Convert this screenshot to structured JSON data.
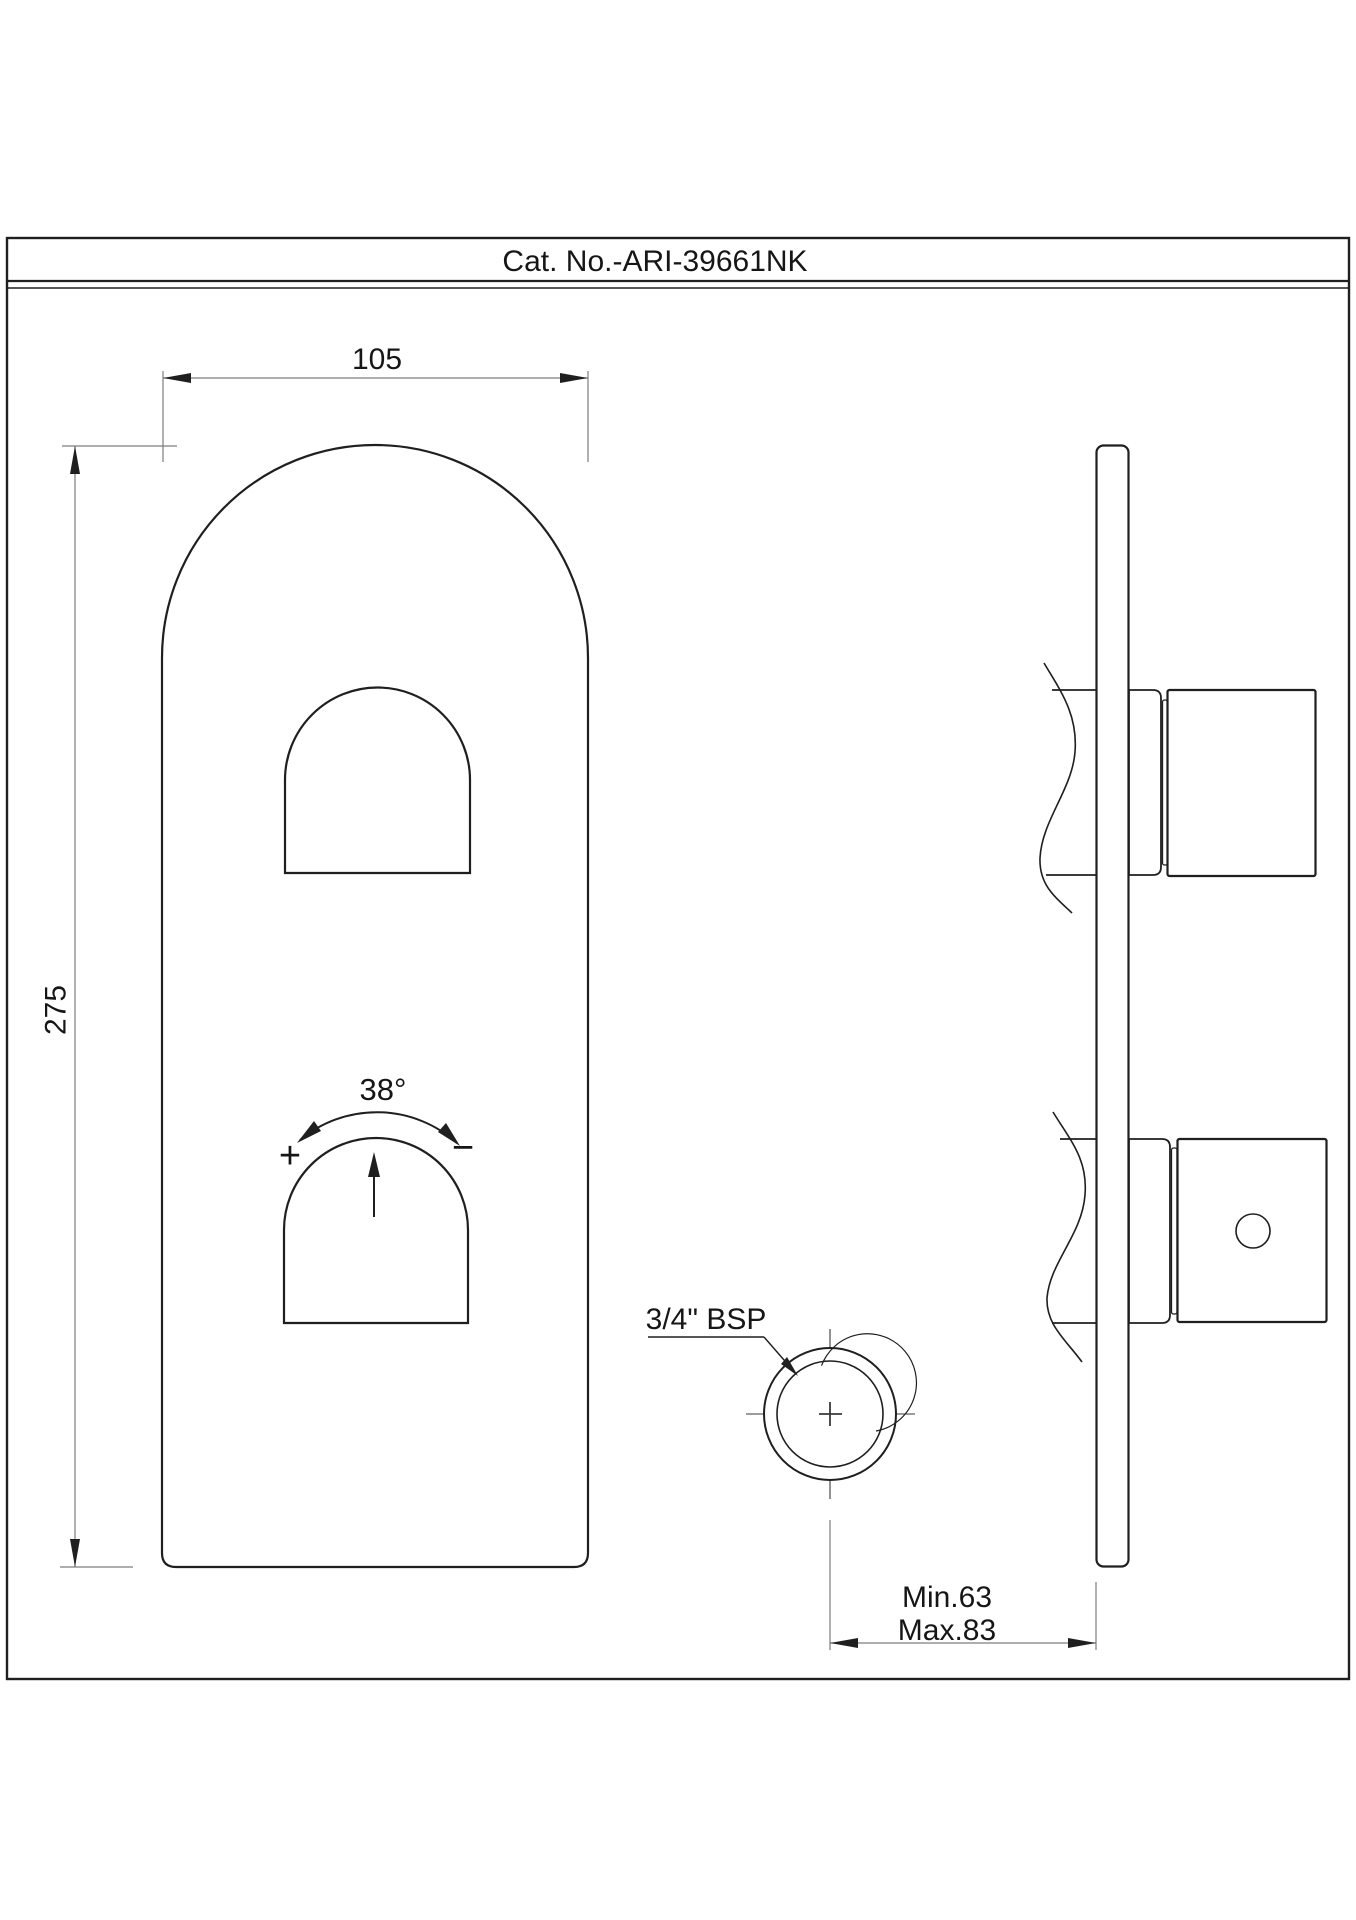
{
  "title": "Cat. No.-ARI-39661NK",
  "drawing": {
    "type": "technical-drawing",
    "views": [
      "front-view-of-concealed-shower-mixer-plate",
      "side-section-view-through-wall"
    ],
    "dimensions": {
      "plate_width": "105",
      "plate_height": "275",
      "rotation_angle": "38°",
      "plus_symbol": "+",
      "minus_symbol": "−",
      "thread_label": "3/4\" BSP",
      "wall_depth_min": "Min.63",
      "wall_depth_max": "Max.83"
    }
  },
  "colors": {
    "outline": "#1f1f1f",
    "dimension_lines": "#7d7d7d",
    "background": "#ffffff",
    "text": "#161616"
  }
}
